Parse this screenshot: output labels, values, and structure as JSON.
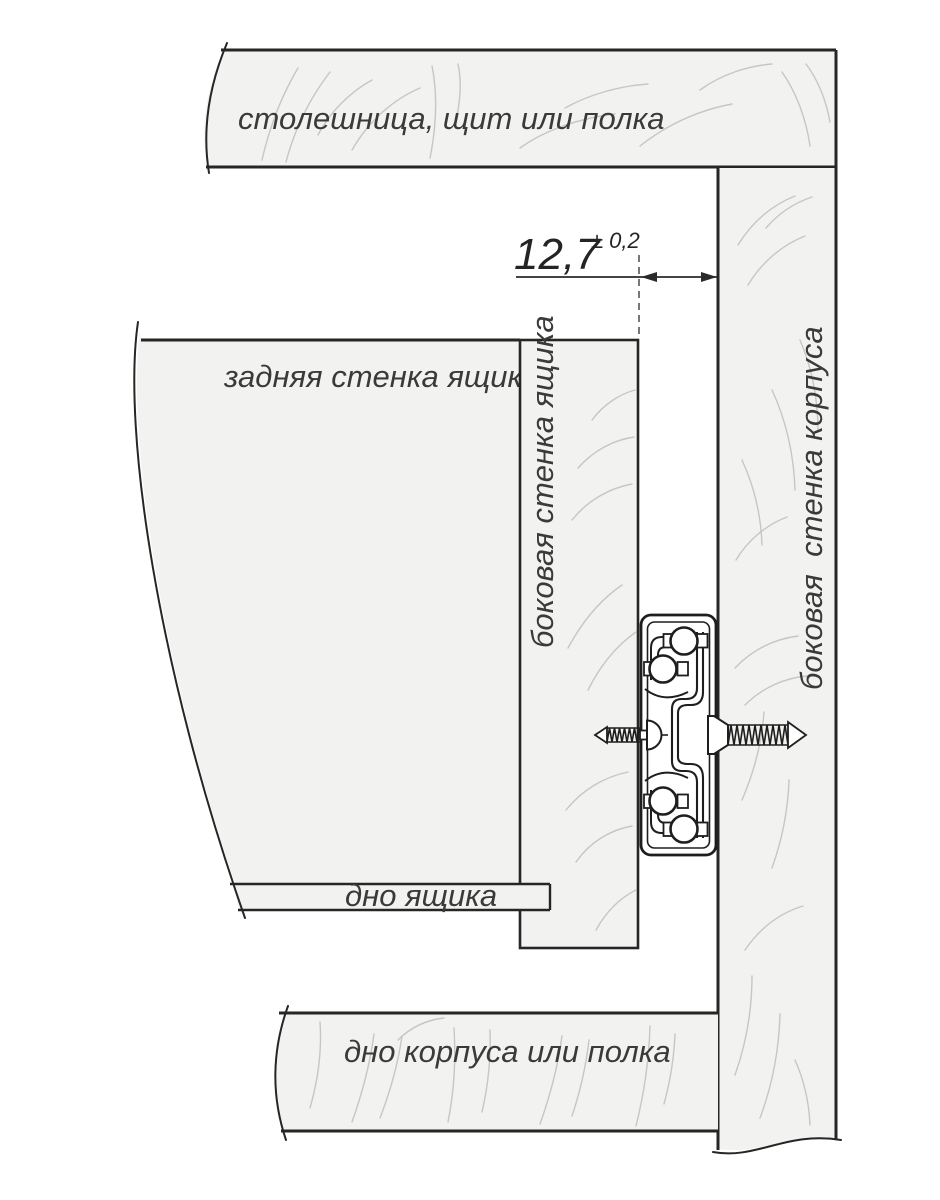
{
  "diagram": {
    "labels": {
      "top_panel": "столешница, щит или полка",
      "drawer_back_wall": "задняя стенка ящика",
      "drawer_side_wall": "боковая стенка ящика",
      "cabinet_side_wall": "боковая  стенка корпуса",
      "drawer_bottom": "дно ящика",
      "cabinet_bottom": "дно корпуса или полка"
    },
    "dimension": {
      "value": "12,7",
      "tolerance": "± 0,2"
    },
    "colors": {
      "panel_fill": "#f2f2f1",
      "outline": "#262626",
      "grain": "#c6c6c6",
      "label_text": "#3a3a3a",
      "background": "#ffffff"
    }
  }
}
